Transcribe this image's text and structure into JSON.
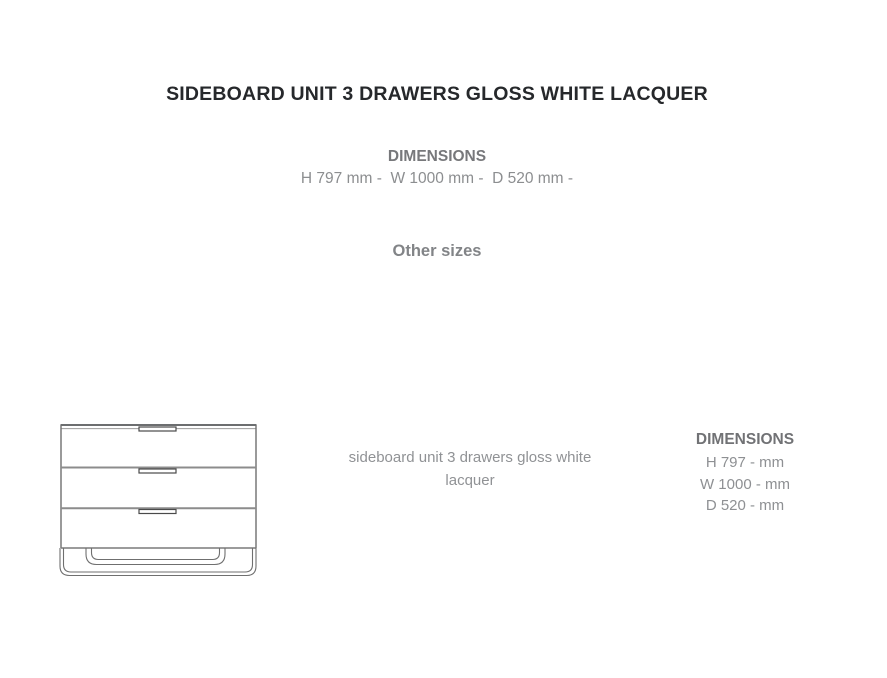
{
  "header": {
    "title": "SIDEBOARD UNIT 3 DRAWERS GLOSS WHITE LACQUER",
    "dimensions_heading": "DIMENSIONS",
    "dimensions_line": "H 797 mm -  W 1000 mm -  D 520 mm -",
    "other_sizes_heading": "Other sizes"
  },
  "product": {
    "drawing": {
      "name": "sideboard unit 3 drawers line drawing",
      "drawer_count": 3
    },
    "description": "sideboard unit 3 drawers gloss white lacquer",
    "dimensions": {
      "heading": "DIMENSIONS",
      "rows": [
        "H 797 - mm",
        "W 1000 - mm",
        "D 520 - mm"
      ]
    }
  },
  "colors": {
    "background": "#ffffff",
    "title_text": "#26282b",
    "heading_gray": "#77787b",
    "body_gray": "#8e9093",
    "drawing_line": "#6f6f6f"
  }
}
